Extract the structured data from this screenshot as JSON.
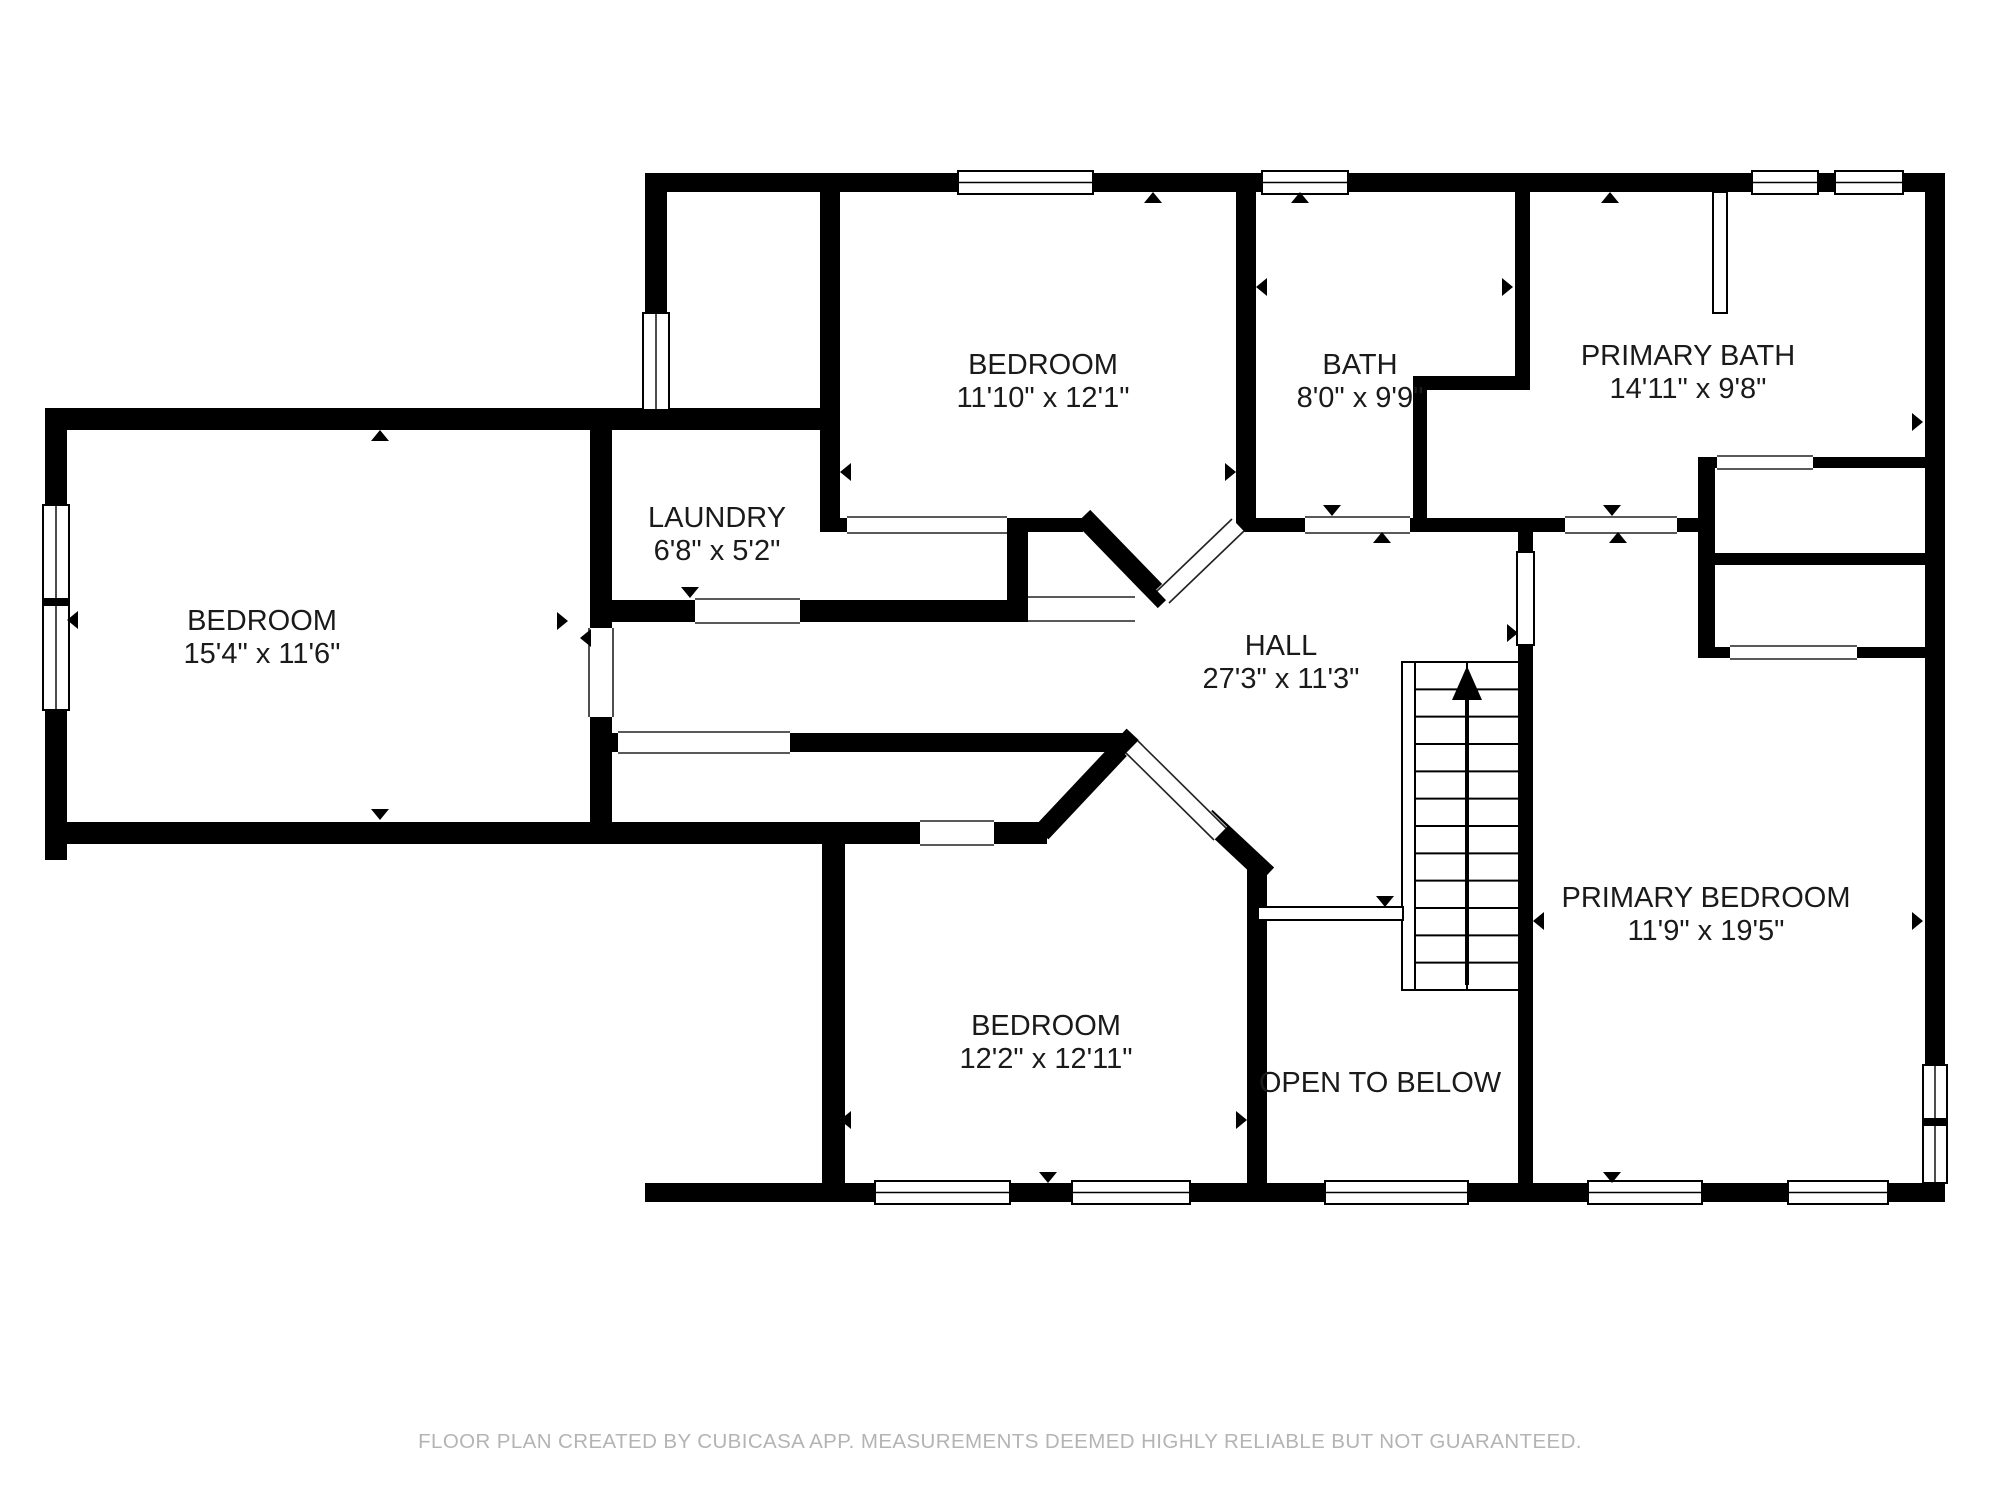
{
  "footer": {
    "disclaimer": "FLOOR PLAN CREATED BY CUBICASA APP. MEASUREMENTS DEEMED HIGHLY RELIABLE BUT NOT GUARANTEED."
  },
  "colors": {
    "wall": "#000000",
    "background": "#ffffff",
    "text": "#1a1a1a",
    "footer_text": "#b4b4b4",
    "opening_line": "#222222"
  },
  "rooms": [
    {
      "id": "bedroom-left",
      "name": "BEDROOM",
      "dims": "15'4\" x 11'6\"",
      "x": 262,
      "y": 630
    },
    {
      "id": "laundry",
      "name": "LAUNDRY",
      "dims": "6'8\" x 5'2\"",
      "x": 717,
      "y": 527
    },
    {
      "id": "bedroom-top",
      "name": "BEDROOM",
      "dims": "11'10\" x 12'1\"",
      "x": 1043,
      "y": 374
    },
    {
      "id": "bath",
      "name": "BATH",
      "dims": "8'0\" x 9'9\"",
      "x": 1360,
      "y": 374
    },
    {
      "id": "primary-bath",
      "name": "PRIMARY BATH",
      "dims": "14'11\" x 9'8\"",
      "x": 1688,
      "y": 365
    },
    {
      "id": "hall",
      "name": "HALL",
      "dims": "27'3\" x 11'3\"",
      "x": 1281,
      "y": 655
    },
    {
      "id": "bedroom-bottom",
      "name": "BEDROOM",
      "dims": "12'2\" x 12'11\"",
      "x": 1046,
      "y": 1035
    },
    {
      "id": "primary-bedroom",
      "name": "PRIMARY BEDROOM",
      "dims": "11'9\" x 19'5\"",
      "x": 1706,
      "y": 907
    },
    {
      "id": "open-to-below",
      "name": "OPEN TO BELOW",
      "dims": "",
      "x": 1380,
      "y": 1092
    }
  ],
  "plan": {
    "label_font_size": 29,
    "label_line_gap": 33,
    "walls": [
      [
        645,
        173,
        1300,
        19
      ],
      [
        1925,
        173,
        20,
        1029
      ],
      [
        645,
        1183,
        1300,
        19
      ],
      [
        645,
        192,
        22,
        216
      ],
      [
        45,
        408,
        600,
        22
      ],
      [
        645,
        408,
        193,
        22
      ],
      [
        45,
        408,
        22,
        452
      ],
      [
        45,
        822,
        875,
        22
      ],
      [
        994,
        822,
        53,
        22
      ],
      [
        822,
        822,
        23,
        380
      ],
      [
        590,
        430,
        22,
        392
      ],
      [
        590,
        600,
        438,
        22
      ],
      [
        820,
        192,
        20,
        340
      ],
      [
        820,
        518,
        263,
        14
      ],
      [
        1007,
        518,
        21,
        104
      ],
      [
        1236,
        192,
        20,
        340
      ],
      [
        1236,
        518,
        69,
        14
      ],
      [
        1410,
        518,
        155,
        14
      ],
      [
        1677,
        518,
        38,
        14
      ],
      [
        1413,
        376,
        117,
        14
      ],
      [
        1413,
        376,
        14,
        156
      ],
      [
        1515,
        192,
        15,
        196
      ],
      [
        1698,
        457,
        17,
        201
      ],
      [
        1698,
        457,
        227,
        11
      ],
      [
        1715,
        553,
        210,
        12
      ],
      [
        1715,
        647,
        210,
        11
      ],
      [
        1518,
        532,
        15,
        20
      ],
      [
        1518,
        645,
        15,
        557
      ],
      [
        590,
        733,
        537,
        19
      ],
      [
        1247,
        862,
        20,
        340
      ]
    ],
    "diag_walls": [
      [
        1090,
        524,
        1158,
        594,
        20
      ],
      [
        1127,
        742,
        1048,
        826,
        19
      ],
      [
        1213,
        824,
        1260,
        868,
        20
      ]
    ],
    "diag_openings": [
      {
        "band": [
          1163,
          597,
          1238,
          525,
          20
        ],
        "edges": [
          [
            1157,
            591,
            1232,
            519
          ],
          [
            1169,
            603,
            1244,
            531
          ]
        ]
      },
      {
        "band": [
          1132,
          747,
          1220,
          834,
          20
        ],
        "edges": [
          [
            1126,
            753,
            1214,
            840
          ],
          [
            1138,
            741,
            1226,
            828
          ]
        ]
      }
    ],
    "windows": [
      {
        "x": 958,
        "y": 171,
        "w": 135,
        "h": 23,
        "o": "h",
        "m": []
      },
      {
        "x": 1262,
        "y": 171,
        "w": 86,
        "h": 23,
        "o": "h",
        "m": []
      },
      {
        "x": 1752,
        "y": 171,
        "w": 66,
        "h": 23,
        "o": "h",
        "m": []
      },
      {
        "x": 1835,
        "y": 171,
        "w": 68,
        "h": 23,
        "o": "h",
        "m": []
      },
      {
        "x": 1923,
        "y": 1065,
        "w": 24,
        "h": 118,
        "o": "v",
        "m": [
          1118
        ]
      },
      {
        "x": 43,
        "y": 505,
        "w": 26,
        "h": 205,
        "o": "v",
        "m": [
          598
        ]
      },
      {
        "x": 875,
        "y": 1181,
        "w": 135,
        "h": 23,
        "o": "h",
        "m": []
      },
      {
        "x": 1072,
        "y": 1181,
        "w": 118,
        "h": 23,
        "o": "h",
        "m": []
      },
      {
        "x": 1325,
        "y": 1181,
        "w": 143,
        "h": 23,
        "o": "h",
        "m": []
      },
      {
        "x": 1588,
        "y": 1181,
        "w": 114,
        "h": 23,
        "o": "h",
        "m": []
      },
      {
        "x": 1788,
        "y": 1181,
        "w": 100,
        "h": 23,
        "o": "h",
        "m": []
      },
      {
        "x": 643,
        "y": 313,
        "w": 26,
        "h": 97,
        "o": "v",
        "m": []
      }
    ],
    "openings": [
      {
        "x": 588,
        "y": 628,
        "w": 26,
        "h": 89,
        "o": "v"
      },
      {
        "x": 695,
        "y": 598,
        "w": 105,
        "h": 26,
        "o": "h"
      },
      {
        "x": 847,
        "y": 516,
        "w": 160,
        "h": 18,
        "o": "h"
      },
      {
        "x": 1028,
        "y": 596,
        "w": 107,
        "h": 26,
        "o": "h"
      },
      {
        "x": 1305,
        "y": 516,
        "w": 105,
        "h": 18,
        "o": "h"
      },
      {
        "x": 1565,
        "y": 516,
        "w": 112,
        "h": 18,
        "o": "h"
      },
      {
        "x": 1717,
        "y": 455,
        "w": 96,
        "h": 15,
        "o": "h"
      },
      {
        "x": 1730,
        "y": 645,
        "w": 127,
        "h": 15,
        "o": "h"
      },
      {
        "x": 618,
        "y": 731,
        "w": 172,
        "h": 23,
        "o": "h"
      },
      {
        "x": 920,
        "y": 820,
        "w": 74,
        "h": 26,
        "o": "h"
      }
    ],
    "strips": [
      {
        "x": 1402,
        "y": 662,
        "w": 13,
        "h": 328,
        "name": "stair-rail"
      },
      {
        "x": 1517,
        "y": 552,
        "w": 17,
        "h": 93,
        "name": "door-strip"
      },
      {
        "x": 1713,
        "y": 192,
        "w": 14,
        "h": 121,
        "name": "glass-partition"
      },
      {
        "x": 1258,
        "y": 907,
        "w": 145,
        "h": 13,
        "name": "railing"
      }
    ],
    "stairs": {
      "x1": 1415,
      "y1": 662,
      "x2": 1518,
      "y2": 990,
      "tread_lines": 13,
      "center_x": 1467,
      "arrow_tip_y": 666,
      "arrow_base_y": 700,
      "arrow_half_w": 15,
      "shaft_bottom_y": 985
    },
    "arrows": [
      [
        380,
        430,
        "up"
      ],
      [
        380,
        820,
        "down"
      ],
      [
        67,
        620,
        "left"
      ],
      [
        568,
        621,
        "right"
      ],
      [
        580,
        638,
        "left"
      ],
      [
        690,
        598,
        "down"
      ],
      [
        1153,
        192,
        "up"
      ],
      [
        840,
        472,
        "left"
      ],
      [
        1236,
        472,
        "right"
      ],
      [
        1256,
        287,
        "left"
      ],
      [
        1513,
        287,
        "right"
      ],
      [
        1300,
        192,
        "up"
      ],
      [
        1332,
        516,
        "down"
      ],
      [
        1382,
        532,
        "up"
      ],
      [
        1610,
        192,
        "up"
      ],
      [
        1923,
        422,
        "right"
      ],
      [
        1612,
        516,
        "down"
      ],
      [
        1618,
        532,
        "up"
      ],
      [
        1518,
        633,
        "right"
      ],
      [
        1533,
        921,
        "left"
      ],
      [
        1923,
        921,
        "right"
      ],
      [
        1612,
        1183,
        "down"
      ],
      [
        1385,
        907,
        "down"
      ],
      [
        840,
        1120,
        "left"
      ],
      [
        1247,
        1120,
        "right"
      ],
      [
        1048,
        1183,
        "down"
      ]
    ]
  }
}
